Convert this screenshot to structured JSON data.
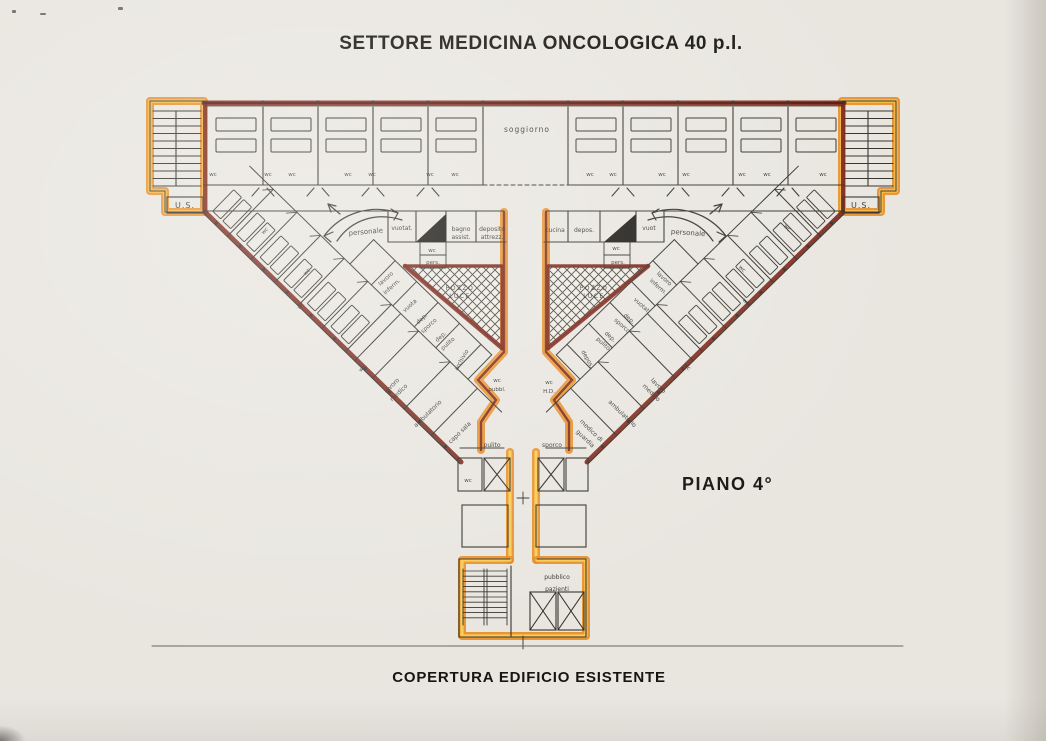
{
  "title": "SETTORE MEDICINA ONCOLOGICA 40 p.l.",
  "floor_label": "PIANO 4°",
  "caption": "COPERTURA EDIFICIO ESISTENTE",
  "colors": {
    "wall_maroon": "#7b2217",
    "wall_maroon_dark": "#5c170e",
    "highlight_orange": "#e8891c",
    "highlight_yellow": "#fbcf56",
    "ink": "#34322b",
    "paper": "#e9e6e0",
    "lightwell_fill": "#efece5",
    "label_ink": "#2e2c27",
    "baseline_gray": "#6b675e"
  },
  "plan_labels": [
    {
      "text": "U.S.",
      "x": 185,
      "y": 208,
      "s": 8,
      "sp": 1
    },
    {
      "text": "U.S.",
      "x": 861,
      "y": 208,
      "s": 8,
      "sp": 1
    },
    {
      "text": "soggiorno",
      "x": 527,
      "y": 132,
      "s": 7.5,
      "sp": 1
    },
    {
      "text": "wc",
      "x": 213,
      "y": 176,
      "s": 5.5
    },
    {
      "text": "wc",
      "x": 268,
      "y": 176,
      "s": 5.5
    },
    {
      "text": "wc",
      "x": 292,
      "y": 176,
      "s": 5.5
    },
    {
      "text": "wc",
      "x": 348,
      "y": 176,
      "s": 5.5
    },
    {
      "text": "wc",
      "x": 372,
      "y": 176,
      "s": 5.5
    },
    {
      "text": "wc",
      "x": 430,
      "y": 176,
      "s": 5.5
    },
    {
      "text": "wc",
      "x": 455,
      "y": 176,
      "s": 5.5
    },
    {
      "text": "wc",
      "x": 590,
      "y": 176,
      "s": 5.5
    },
    {
      "text": "wc",
      "x": 613,
      "y": 176,
      "s": 5.5
    },
    {
      "text": "wc",
      "x": 662,
      "y": 176,
      "s": 5.5
    },
    {
      "text": "wc",
      "x": 686,
      "y": 176,
      "s": 5.5
    },
    {
      "text": "wc",
      "x": 742,
      "y": 176,
      "s": 5.5
    },
    {
      "text": "wc",
      "x": 767,
      "y": 176,
      "s": 5.5
    },
    {
      "text": "wc",
      "x": 823,
      "y": 176,
      "s": 5.5
    },
    {
      "text": "personale",
      "x": 366,
      "y": 234,
      "s": 7,
      "rot": -5
    },
    {
      "text": "vuotat.",
      "x": 402,
      "y": 230,
      "s": 6
    },
    {
      "text": "bagno",
      "x": 461,
      "y": 231,
      "s": 6
    },
    {
      "text": "assist.",
      "x": 461,
      "y": 239,
      "s": 6
    },
    {
      "text": "deposito",
      "x": 492,
      "y": 231,
      "s": 6
    },
    {
      "text": "attrezz.",
      "x": 492,
      "y": 239,
      "s": 6
    },
    {
      "text": "wc",
      "x": 432,
      "y": 252,
      "s": 5.5
    },
    {
      "text": "pers.",
      "x": 433,
      "y": 264,
      "s": 5.5
    },
    {
      "text": "cucina",
      "x": 555,
      "y": 232,
      "s": 6
    },
    {
      "text": "depos.",
      "x": 584,
      "y": 232,
      "s": 6
    },
    {
      "text": "vuot",
      "x": 649,
      "y": 230,
      "s": 6
    },
    {
      "text": "personale",
      "x": 688,
      "y": 235,
      "s": 7,
      "rot": 4
    },
    {
      "text": "wc",
      "x": 616,
      "y": 250,
      "s": 5.5
    },
    {
      "text": "pers.",
      "x": 618,
      "y": 264,
      "s": 5.5
    },
    {
      "text": "POZZO",
      "x": 460,
      "y": 290,
      "s": 6,
      "sp": 1.5
    },
    {
      "text": "LUCE",
      "x": 460,
      "y": 298,
      "s": 6,
      "sp": 1.5
    },
    {
      "text": "POZZO",
      "x": 594,
      "y": 290,
      "s": 6,
      "sp": 1.5
    },
    {
      "text": "LUCE",
      "x": 594,
      "y": 298,
      "s": 6,
      "sp": 1.5
    },
    {
      "text": "wc",
      "x": 266,
      "y": 232,
      "s": 5.5,
      "rot": -45
    },
    {
      "text": "wc",
      "x": 308,
      "y": 273,
      "s": 5.5,
      "rot": -45
    },
    {
      "text": "wc",
      "x": 302,
      "y": 307,
      "s": 5.5,
      "rot": -45
    },
    {
      "text": "lavoro",
      "x": 387,
      "y": 280,
      "s": 5.8,
      "rot": -42
    },
    {
      "text": "inferm.",
      "x": 393,
      "y": 288,
      "s": 5.8,
      "rot": -42
    },
    {
      "text": "vuota",
      "x": 411,
      "y": 307,
      "s": 5.8,
      "rot": -42
    },
    {
      "text": "dep.",
      "x": 423,
      "y": 320,
      "s": 5.8,
      "rot": -42
    },
    {
      "text": "sporco",
      "x": 430,
      "y": 327,
      "s": 5.8,
      "rot": -42
    },
    {
      "text": "dep.",
      "x": 442,
      "y": 338,
      "s": 5.8,
      "rot": -42
    },
    {
      "text": "pulito",
      "x": 449,
      "y": 345,
      "s": 5.8,
      "rot": -42
    },
    {
      "text": "archivio",
      "x": 463,
      "y": 361,
      "s": 5.8,
      "rot": -60
    },
    {
      "text": "wc.",
      "x": 364,
      "y": 369,
      "s": 5.5,
      "rot": -45
    },
    {
      "text": "lavoro",
      "x": 393,
      "y": 387,
      "s": 6,
      "rot": -44
    },
    {
      "text": "medico",
      "x": 400,
      "y": 394,
      "s": 6,
      "rot": -44
    },
    {
      "text": "ambulatorio",
      "x": 429,
      "y": 415,
      "s": 6,
      "rot": -44
    },
    {
      "text": "capo sala",
      "x": 461,
      "y": 434,
      "s": 6,
      "rot": -44
    },
    {
      "text": "wc",
      "x": 786,
      "y": 229,
      "s": 5.5,
      "rot": 45
    },
    {
      "text": "wc",
      "x": 741,
      "y": 270,
      "s": 5.5,
      "rot": 45
    },
    {
      "text": "wc",
      "x": 745,
      "y": 303,
      "s": 5.5,
      "rot": 45
    },
    {
      "text": "lavoro",
      "x": 663,
      "y": 280,
      "s": 5.8,
      "rot": 42
    },
    {
      "text": "inferm.",
      "x": 657,
      "y": 288,
      "s": 5.8,
      "rot": 42
    },
    {
      "text": "vuotat.",
      "x": 641,
      "y": 307,
      "s": 5.8,
      "rot": 42
    },
    {
      "text": "dep.",
      "x": 628,
      "y": 320,
      "s": 5.8,
      "rot": 42
    },
    {
      "text": "sporco",
      "x": 621,
      "y": 327,
      "s": 5.8,
      "rot": 42
    },
    {
      "text": "dep.",
      "x": 609,
      "y": 338,
      "s": 5.8,
      "rot": 42
    },
    {
      "text": "pulito",
      "x": 602,
      "y": 345,
      "s": 5.8,
      "rot": 42
    },
    {
      "text": "depos.",
      "x": 586,
      "y": 360,
      "s": 5.8,
      "rot": 60
    },
    {
      "text": "wc",
      "x": 686,
      "y": 368,
      "s": 5.5,
      "rot": 45
    },
    {
      "text": "lavoro",
      "x": 657,
      "y": 387,
      "s": 6,
      "rot": 44
    },
    {
      "text": "medico",
      "x": 650,
      "y": 394,
      "s": 6,
      "rot": 44
    },
    {
      "text": "ambulatorio",
      "x": 621,
      "y": 415,
      "s": 6,
      "rot": 44
    },
    {
      "text": "medico di",
      "x": 590,
      "y": 432,
      "s": 6,
      "rot": 44
    },
    {
      "text": "guardia",
      "x": 584,
      "y": 440,
      "s": 6,
      "rot": 44
    },
    {
      "text": "wc",
      "x": 497,
      "y": 382,
      "s": 5.5
    },
    {
      "text": "pubbl.",
      "x": 497,
      "y": 391,
      "s": 5.5
    },
    {
      "text": "wc",
      "x": 549,
      "y": 384,
      "s": 5.5
    },
    {
      "text": "H.D.",
      "x": 549,
      "y": 393,
      "s": 5.5
    },
    {
      "text": "pulito",
      "x": 492,
      "y": 447,
      "s": 6
    },
    {
      "text": "sporco",
      "x": 552,
      "y": 447,
      "s": 6
    },
    {
      "text": "wc",
      "x": 468,
      "y": 482,
      "s": 5.5
    },
    {
      "text": "pubblico",
      "x": 557,
      "y": 579,
      "s": 6
    },
    {
      "text": "pazienti",
      "x": 557,
      "y": 591,
      "s": 6
    }
  ]
}
